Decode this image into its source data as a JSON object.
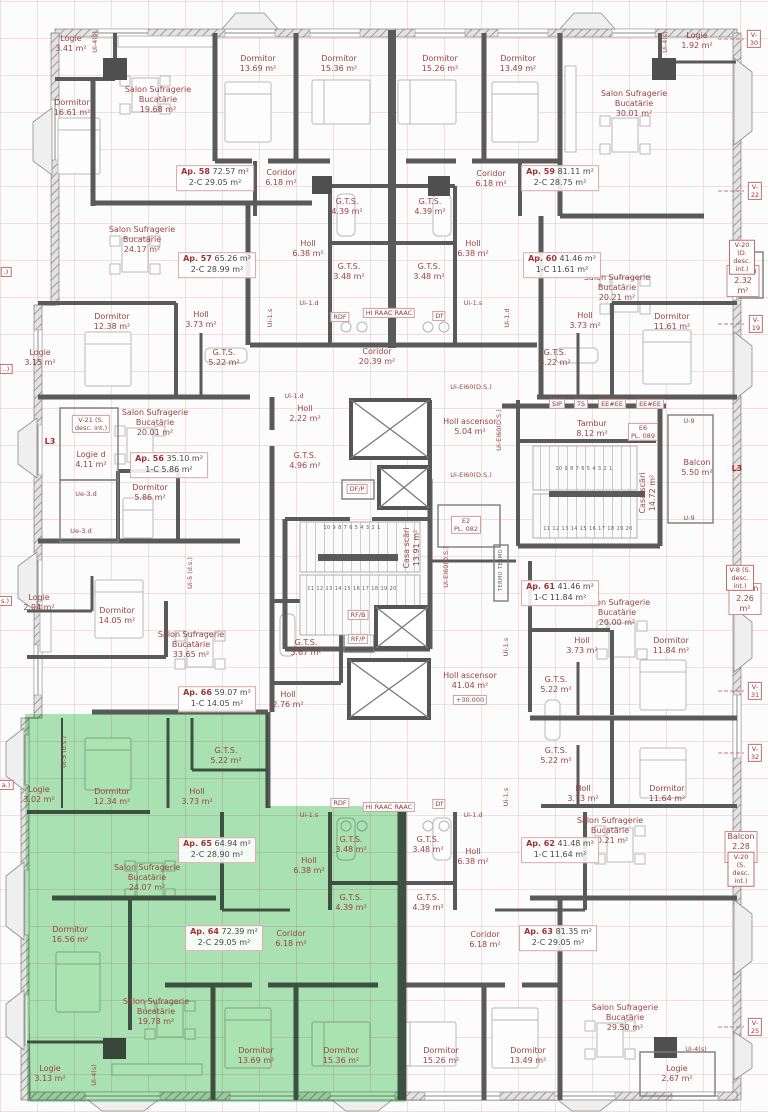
{
  "drawing": {
    "type": "apartment-building floor plan",
    "highlight_color": "#59c96a",
    "wall_color": "#5a5a5a",
    "label_color": "#9a4343",
    "level_mark": "+30.000"
  },
  "rooms": [
    {
      "n": "Logie",
      "a": "3.41 m²",
      "x": 71,
      "y": 44
    },
    {
      "n": "Dormitor",
      "a": "16.61 m²",
      "x": 72,
      "y": 108
    },
    {
      "n": "Salon Sufragerie\nBucatärie",
      "a": "19.68 m²",
      "x": 158,
      "y": 100
    },
    {
      "n": "Dormitor",
      "a": "13.69 m²",
      "x": 258,
      "y": 64
    },
    {
      "n": "Dormitor",
      "a": "15.36 m²",
      "x": 339,
      "y": 64
    },
    {
      "n": "Dormitor",
      "a": "15.26 m²",
      "x": 440,
      "y": 64
    },
    {
      "n": "Dormitor",
      "a": "13.49 m²",
      "x": 518,
      "y": 64
    },
    {
      "n": "Salon Sufragerie\nBucatärie",
      "a": "30.01 m²",
      "x": 634,
      "y": 104
    },
    {
      "n": "Logie",
      "a": "1.92 m²",
      "x": 697,
      "y": 41
    },
    {
      "n": "Coridor",
      "a": "6.18 m²",
      "x": 281,
      "y": 178
    },
    {
      "n": "Coridor",
      "a": "6.18 m²",
      "x": 491,
      "y": 179
    },
    {
      "n": "G.T.S.",
      "a": "4.39 m²",
      "x": 347,
      "y": 207
    },
    {
      "n": "G.T.S.",
      "a": "4.39 m²",
      "x": 430,
      "y": 207
    },
    {
      "n": "Holl",
      "a": "6.38 m²",
      "x": 308,
      "y": 249
    },
    {
      "n": "Holl",
      "a": "6.38 m²",
      "x": 473,
      "y": 249
    },
    {
      "n": "G.T.S.",
      "a": "3.48 m²",
      "x": 349,
      "y": 272
    },
    {
      "n": "G.T.S.",
      "a": "3.48 m²",
      "x": 429,
      "y": 272
    },
    {
      "n": "Salon Sufragerie\nBucatärie",
      "a": "24.17 m²",
      "x": 142,
      "y": 240
    },
    {
      "n": "Salon Sufragerie\nBucatärie",
      "a": "20.21 m²",
      "x": 617,
      "y": 288
    },
    {
      "n": "Dormitor",
      "a": "12.38 m²",
      "x": 112,
      "y": 322
    },
    {
      "n": "Holl",
      "a": "3.73 m²",
      "x": 201,
      "y": 320
    },
    {
      "n": "Holl",
      "a": "3.73 m²",
      "x": 585,
      "y": 321
    },
    {
      "n": "Dormitor",
      "a": "11.61 m²",
      "x": 672,
      "y": 322
    },
    {
      "n": "Logie",
      "a": "3.15 m²",
      "x": 40,
      "y": 358
    },
    {
      "n": "G.T.S.",
      "a": "5.22 m²",
      "x": 224,
      "y": 358
    },
    {
      "n": "G.T.S.",
      "a": "5.22 m²",
      "x": 555,
      "y": 358
    },
    {
      "n": "Coridor",
      "a": "20.39 m²",
      "x": 377,
      "y": 357
    },
    {
      "n": "Balcon",
      "a": "2.32 m²",
      "x": 743,
      "y": 281,
      "bx": true
    },
    {
      "n": "Logie d",
      "a": "4.11 m²",
      "x": 91,
      "y": 460
    },
    {
      "n": "Salon Sufragerie\nBucatärie",
      "a": "20.01 m²",
      "x": 155,
      "y": 423
    },
    {
      "n": "Dormitor",
      "a": "5.86 m²",
      "x": 150,
      "y": 493
    },
    {
      "n": "Holl",
      "a": "2.22 m²",
      "x": 305,
      "y": 414
    },
    {
      "n": "G.T.S.",
      "a": "4.96 m²",
      "x": 305,
      "y": 461
    },
    {
      "n": "Holl ascensor",
      "a": "5.04 m²",
      "x": 470,
      "y": 427
    },
    {
      "n": "Tambur",
      "a": "8.12 m²",
      "x": 592,
      "y": 429
    },
    {
      "n": "Balcon",
      "a": "5.50 m²",
      "x": 697,
      "y": 468
    },
    {
      "n": "Casa scări",
      "a": "13.91 m²",
      "x": 412,
      "y": 548,
      "rot": -90
    },
    {
      "n": "Casa scări",
      "a": "14.72 m²",
      "x": 648,
      "y": 493,
      "rot": -90
    },
    {
      "n": "Logie",
      "a": "2.94 m²",
      "x": 39,
      "y": 603
    },
    {
      "n": "Dormitor",
      "a": "14.05 m²",
      "x": 117,
      "y": 616
    },
    {
      "n": "Salon Sufragerie\nBucatärie",
      "a": "33.65 m²",
      "x": 191,
      "y": 645
    },
    {
      "n": "G.T.S.",
      "a": "5.67 m²",
      "x": 306,
      "y": 648
    },
    {
      "n": "Holl",
      "a": "2.76 m²",
      "x": 288,
      "y": 700
    },
    {
      "n": "Holl ascensor",
      "a": "41.04 m²",
      "x": 470,
      "y": 681
    },
    {
      "n": "Salon Sufragerie\nBucatärie",
      "a": "20.00 m²",
      "x": 617,
      "y": 613
    },
    {
      "n": "Holl",
      "a": "3.73 m²",
      "x": 582,
      "y": 646
    },
    {
      "n": "Dormitor",
      "a": "11.84 m²",
      "x": 671,
      "y": 646
    },
    {
      "n": "G.T.S.",
      "a": "5.22 m²",
      "x": 556,
      "y": 685
    },
    {
      "n": "Balcon",
      "a": "2.26 m²",
      "x": 745,
      "y": 599,
      "bx": true
    },
    {
      "n": "G.T.S.",
      "a": "5.22 m²",
      "x": 556,
      "y": 756
    },
    {
      "n": "Holl",
      "a": "3.73 m²",
      "x": 583,
      "y": 794
    },
    {
      "n": "Dormitor",
      "a": "11.64 m²",
      "x": 667,
      "y": 794
    },
    {
      "n": "Logie",
      "a": "3.02 m²",
      "x": 39,
      "y": 795
    },
    {
      "n": "Dormitor",
      "a": "12.34 m²",
      "x": 112,
      "y": 797
    },
    {
      "n": "G.T.S.",
      "a": "5.22 m²",
      "x": 226,
      "y": 756
    },
    {
      "n": "Holl",
      "a": "3.73 m²",
      "x": 197,
      "y": 797
    },
    {
      "n": "Salon Sufragerie\nBucatärie",
      "a": "24.07 m²",
      "x": 147,
      "y": 878
    },
    {
      "n": "Dormitor",
      "a": "16.56 m²",
      "x": 70,
      "y": 935
    },
    {
      "n": "Salon Sufragerie\nBucatärie",
      "a": "19.78 m²",
      "x": 156,
      "y": 1012
    },
    {
      "n": "Logie",
      "a": "3.13 m²",
      "x": 50,
      "y": 1074
    },
    {
      "n": "Holl",
      "a": "6.38 m²",
      "x": 309,
      "y": 866
    },
    {
      "n": "G.T.S.",
      "a": "3.48 m²",
      "x": 351,
      "y": 845
    },
    {
      "n": "G.T.S.",
      "a": "4.39 m²",
      "x": 351,
      "y": 903
    },
    {
      "n": "Coridor",
      "a": "6.18 m²",
      "x": 291,
      "y": 939
    },
    {
      "n": "Dormitor",
      "a": "13.69 m²",
      "x": 256,
      "y": 1056
    },
    {
      "n": "Dormitor",
      "a": "15.36 m²",
      "x": 341,
      "y": 1056
    },
    {
      "n": "Holl",
      "a": "6.38 m²",
      "x": 473,
      "y": 857
    },
    {
      "n": "G.T.S.",
      "a": "3.48 m²",
      "x": 428,
      "y": 845
    },
    {
      "n": "G.T.S.",
      "a": "4.39 m²",
      "x": 428,
      "y": 903
    },
    {
      "n": "Coridor",
      "a": "6.18 m²",
      "x": 485,
      "y": 940
    },
    {
      "n": "Dormitor",
      "a": "15.26 m²",
      "x": 441,
      "y": 1056
    },
    {
      "n": "Dormitor",
      "a": "13.49 m²",
      "x": 528,
      "y": 1056
    },
    {
      "n": "Salon Sufragerie\nBucatärie",
      "a": "20.21 m²",
      "x": 610,
      "y": 831
    },
    {
      "n": "Balcon",
      "a": "2.28 m²",
      "x": 741,
      "y": 847,
      "bx": true
    },
    {
      "n": "Salon Sufragerie\nBucatärie",
      "a": "29.50 m²",
      "x": 625,
      "y": 1018
    },
    {
      "n": "Logie",
      "a": "2.67 m²",
      "x": 677,
      "y": 1074
    }
  ],
  "apartments": [
    {
      "id": "Ap. 58",
      "total": "72.57 m²",
      "type": "2-C",
      "area2": "29.05 m²",
      "x": 215,
      "y": 178
    },
    {
      "id": "Ap. 59",
      "total": "81.11 m²",
      "type": "2-C",
      "area2": "28.75 m²",
      "x": 560,
      "y": 178
    },
    {
      "id": "Ap. 57",
      "total": "65.26 m²",
      "type": "2-C",
      "area2": "28.99 m²",
      "x": 217,
      "y": 265
    },
    {
      "id": "Ap. 60",
      "total": "41.46 m²",
      "type": "1-C",
      "area2": "11.61 m²",
      "x": 562,
      "y": 265
    },
    {
      "id": "Ap. 56",
      "total": "35.10 m²",
      "type": "1-C",
      "area2": "5.86 m²",
      "x": 169,
      "y": 465
    },
    {
      "id": "Ap. 66",
      "total": "59.07 m²",
      "type": "1-C",
      "area2": "14.05 m²",
      "x": 217,
      "y": 699
    },
    {
      "id": "Ap. 61",
      "total": "41.46 m²",
      "type": "1-C",
      "area2": "11.84 m²",
      "x": 560,
      "y": 593
    },
    {
      "id": "Ap. 62",
      "total": "41.48 m²",
      "type": "1-C",
      "area2": "11.64 m²",
      "x": 560,
      "y": 850
    },
    {
      "id": "Ap. 65",
      "total": "64.94 m²",
      "type": "2-C",
      "area2": "28.90 m²",
      "x": 217,
      "y": 850
    },
    {
      "id": "Ap. 64",
      "total": "72.39 m²",
      "type": "2-C",
      "area2": "29.05 m²",
      "x": 224,
      "y": 938
    },
    {
      "id": "Ap. 63",
      "total": "81.35 m²",
      "type": "2-C",
      "area2": "29.05 m²",
      "x": 558,
      "y": 938
    }
  ],
  "tags": [
    {
      "t": "Ui-4(s)",
      "x": 95,
      "y": 42,
      "rot": -90
    },
    {
      "t": "Ui-4(s)",
      "x": 665,
      "y": 42,
      "rot": -90
    },
    {
      "t": "Ui-1.s",
      "x": 270,
      "y": 318,
      "rot": -90
    },
    {
      "t": "Ui-1.d",
      "x": 507,
      "y": 318,
      "rot": -90
    },
    {
      "t": "Ui-1.d",
      "x": 309,
      "y": 303
    },
    {
      "t": "Ui-1.s",
      "x": 473,
      "y": 303
    },
    {
      "t": "RDF",
      "x": 340,
      "y": 317,
      "bx": true
    },
    {
      "t": "HI  RAAC  RAAC",
      "x": 389,
      "y": 313,
      "bx": true
    },
    {
      "t": "Df",
      "x": 439,
      "y": 316,
      "bx": true
    },
    {
      "t": "Ui-1.d",
      "x": 294,
      "y": 396
    },
    {
      "t": "Ui-EI60(D.S.)",
      "x": 471,
      "y": 387
    },
    {
      "t": "V-21 (S.\ndesc. int.)",
      "x": 91,
      "y": 424,
      "bx": true
    },
    {
      "t": "L3",
      "x": 50,
      "y": 442,
      "red": true
    },
    {
      "t": "Ue-3.d",
      "x": 86,
      "y": 494
    },
    {
      "t": "Ue-3.d",
      "x": 81,
      "y": 531
    },
    {
      "t": "Ui-5 (d.s.)",
      "x": 190,
      "y": 573,
      "rot": -90
    },
    {
      "t": "DF/P",
      "x": 357,
      "y": 489,
      "bx": true
    },
    {
      "t": "SIP",
      "x": 557,
      "y": 404,
      "bx": true
    },
    {
      "t": "TS",
      "x": 581,
      "y": 404,
      "bx": true
    },
    {
      "t": "EE#EE",
      "x": 612,
      "y": 404,
      "bx": true
    },
    {
      "t": "EE#EE",
      "x": 650,
      "y": 404,
      "bx": true
    },
    {
      "t": "E6\nPL. 089",
      "x": 643,
      "y": 432,
      "bx": true
    },
    {
      "t": "U-9",
      "x": 689,
      "y": 421
    },
    {
      "t": "U-9",
      "x": 689,
      "y": 518
    },
    {
      "t": "L3",
      "x": 737,
      "y": 469,
      "red": true
    },
    {
      "t": "10 9 8 7 6 5 4 3 2 1",
      "x": 352,
      "y": 528,
      "tiny": true
    },
    {
      "t": "11 12 13 14 15 16 17 18 19 20",
      "x": 352,
      "y": 589,
      "tiny": true
    },
    {
      "t": "10 9 8 7 6 5 4 3 2 1",
      "x": 584,
      "y": 469,
      "tiny": true
    },
    {
      "t": "11 12 13 14 15 16 17 18 19 20",
      "x": 588,
      "y": 529,
      "tiny": true
    },
    {
      "t": "E2\nPL. 082",
      "x": 466,
      "y": 525,
      "bx": true
    },
    {
      "t": "Ui-EI60(D.S.)",
      "x": 499,
      "y": 430,
      "rot": -90
    },
    {
      "t": "Ui-EI60(D.S.)",
      "x": 471,
      "y": 475
    },
    {
      "t": "Ui-EI60(D.S.)",
      "x": 446,
      "y": 567,
      "rot": -90
    },
    {
      "t": "TERMO TERMO",
      "x": 501,
      "y": 570,
      "rot": -90,
      "tiny": true
    },
    {
      "t": "RF/B",
      "x": 358,
      "y": 615,
      "bx": true
    },
    {
      "t": "RF/P",
      "x": 358,
      "y": 639,
      "bx": true
    },
    {
      "t": "Ui-1.s",
      "x": 506,
      "y": 647,
      "rot": -90
    },
    {
      "t": "Ui-1.s",
      "x": 506,
      "y": 797,
      "rot": -90
    },
    {
      "t": "+30.000",
      "x": 470,
      "y": 700,
      "bx": true
    },
    {
      "t": "Ui-1.s",
      "x": 309,
      "y": 815
    },
    {
      "t": "Ui-1.d",
      "x": 473,
      "y": 815
    },
    {
      "t": "RDF",
      "x": 340,
      "y": 803,
      "bx": true
    },
    {
      "t": "HI  RAAC  RAAC",
      "x": 389,
      "y": 807,
      "bx": true
    },
    {
      "t": "Df",
      "x": 439,
      "y": 804,
      "bx": true
    },
    {
      "t": "Ui-5 (d.s.)",
      "x": 64,
      "y": 752,
      "rot": -90
    },
    {
      "t": "Ui-4(s)",
      "x": 94,
      "y": 1075,
      "rot": -90
    },
    {
      "t": "Ui-4(s)",
      "x": 696,
      "y": 1049
    }
  ],
  "axis_labels": [
    {
      "t": "V-30",
      "x": 754,
      "y": 39
    },
    {
      "t": "V-22",
      "x": 755,
      "y": 191
    },
    {
      "t": "V-20 (D.\ndesc. int.)",
      "x": 742,
      "y": 257
    },
    {
      "t": "V-19",
      "x": 756,
      "y": 324
    },
    {
      "t": "V-8 (S.\ndesc. int.)",
      "x": 740,
      "y": 578
    },
    {
      "t": "V-31",
      "x": 755,
      "y": 691
    },
    {
      "t": "V-32",
      "x": 755,
      "y": 753
    },
    {
      "t": "V-20 (S.\ndesc. int.)",
      "x": 741,
      "y": 869
    },
    {
      "t": "V-25",
      "x": 755,
      "y": 1027
    },
    {
      "t": ".)",
      "x": 6,
      "y": 272
    },
    {
      "t": "..)",
      "x": 6,
      "y": 369
    },
    {
      "t": "s.)",
      "x": 5,
      "y": 601
    },
    {
      "t": "a.)",
      "x": 6,
      "y": 785
    }
  ]
}
